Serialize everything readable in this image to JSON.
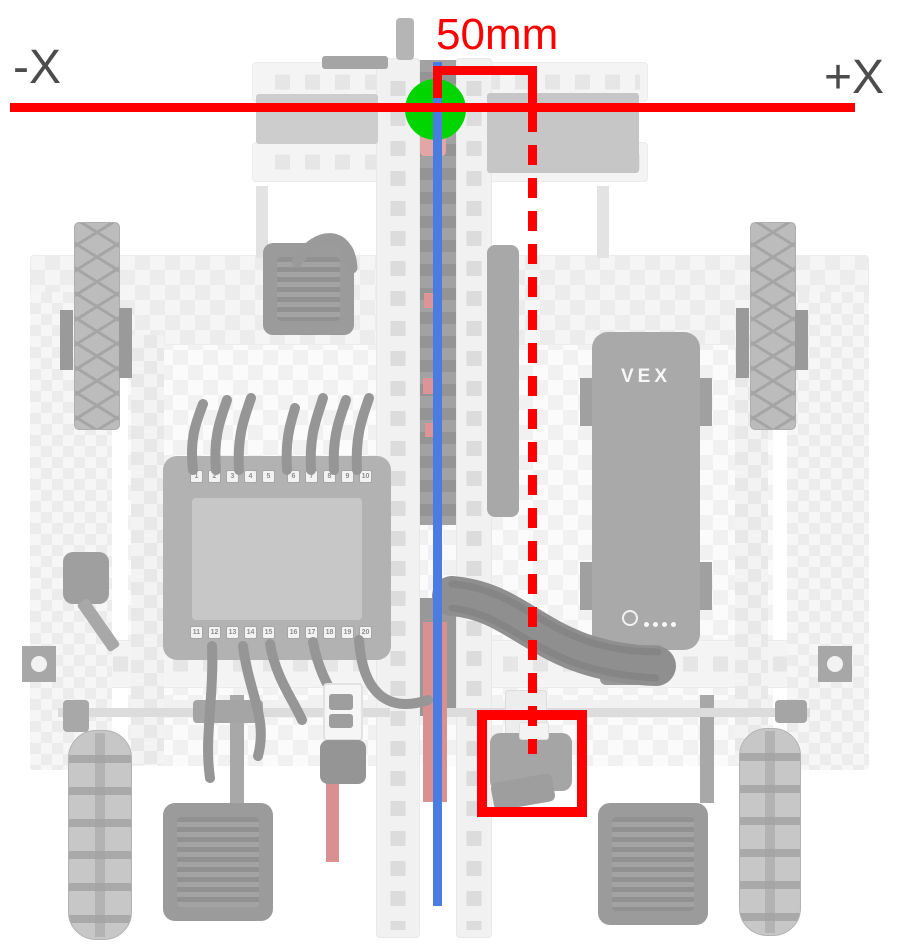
{
  "annotations": {
    "measurement_label": "50mm",
    "axis_negative_label": "-X",
    "axis_positive_label": "+X",
    "colors": {
      "axis_red": "#fe0000",
      "origin_green": "#00d500",
      "center_line_blue": "#4a7ce1",
      "label_gray": "#4c4c4c",
      "faded_pink": "#d89090"
    }
  },
  "robot": {
    "battery_logo": "VEX",
    "brain_ports_top": [
      "1",
      "2",
      "3",
      "4",
      "5",
      "6",
      "7",
      "8",
      "9",
      "10"
    ],
    "brain_ports_bottom": [
      "11",
      "12",
      "13",
      "14",
      "15",
      "16",
      "17",
      "18",
      "19",
      "20"
    ]
  }
}
